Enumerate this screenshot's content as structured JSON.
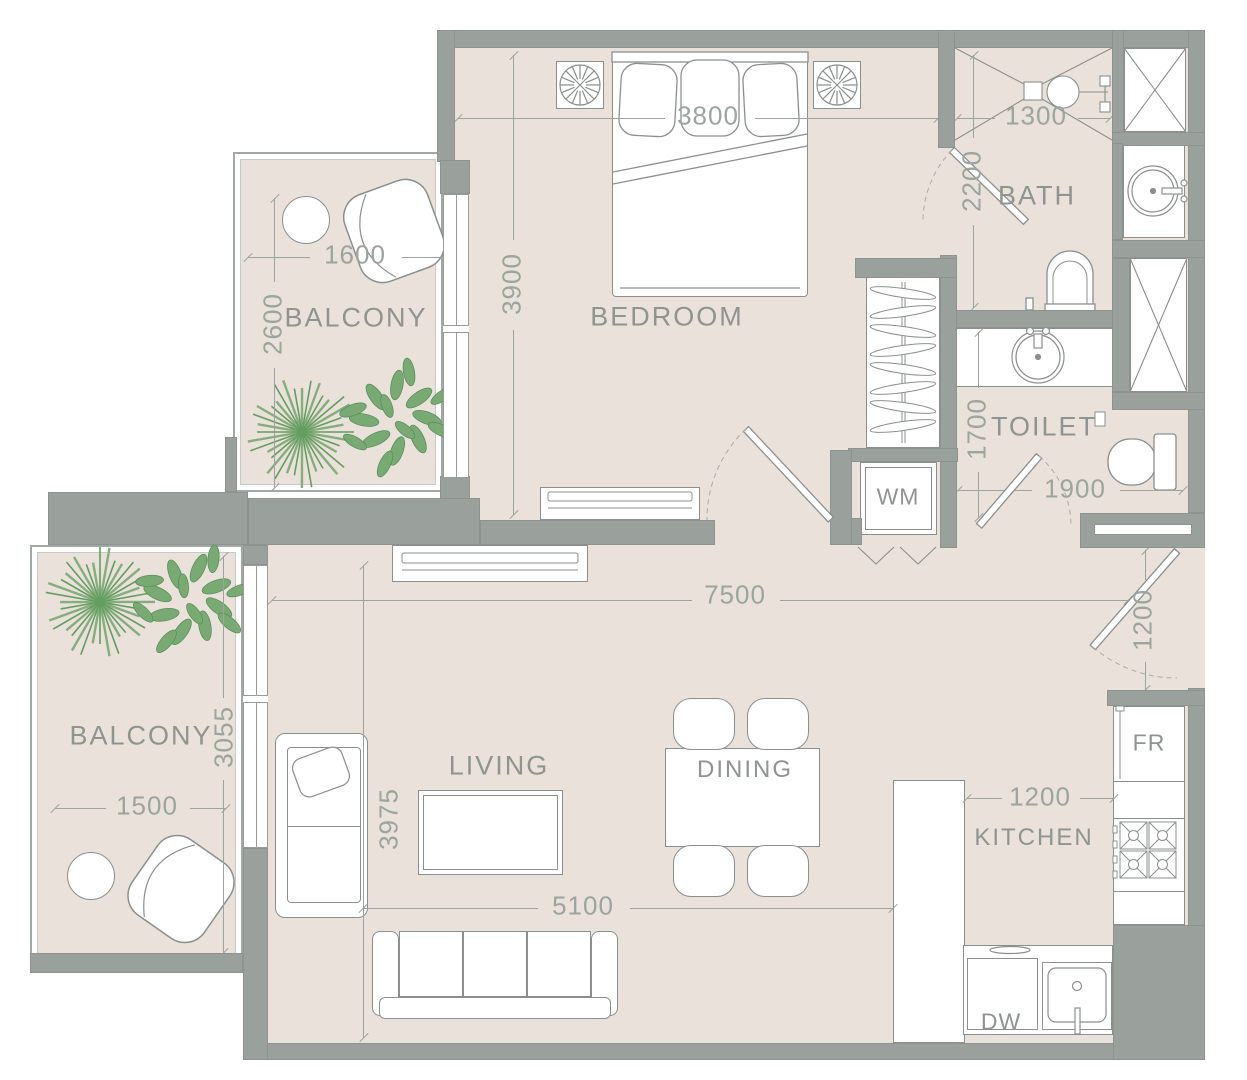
{
  "plan_type": "apartment-floor-plan",
  "colors": {
    "background": "#ffffff",
    "floor": "#eae1db",
    "wall": "#9aa19c",
    "furniture_line": "#8b908e",
    "dimension_line": "#9ba49e",
    "label_text": "#8f9490",
    "plant_green": "#639e60",
    "plant_light": "#86ad7e"
  },
  "rooms": {
    "bedroom": {
      "label": "BEDROOM",
      "width": "3800",
      "depth": "3900"
    },
    "bath": {
      "label": "BATH",
      "width": "1300",
      "depth": "2200"
    },
    "toilet": {
      "label": "TOILET",
      "width": "1900",
      "depth": "1700"
    },
    "balcony_upper": {
      "label": "BALCONY",
      "width": "1600",
      "depth": "2600"
    },
    "balcony_lower": {
      "label": "BALCONY",
      "width": "1500",
      "depth": "3055"
    },
    "living": {
      "label": "LIVING",
      "width": "5100",
      "depth": "3975"
    },
    "dining": {
      "label": "DINING"
    },
    "kitchen": {
      "label": "KITCHEN",
      "width": "1200"
    },
    "hall": {
      "total_width": "7500",
      "entry_width": "1200"
    }
  },
  "appliances": {
    "washing_machine": "WM",
    "fridge": "FR",
    "dishwasher": "DW"
  }
}
